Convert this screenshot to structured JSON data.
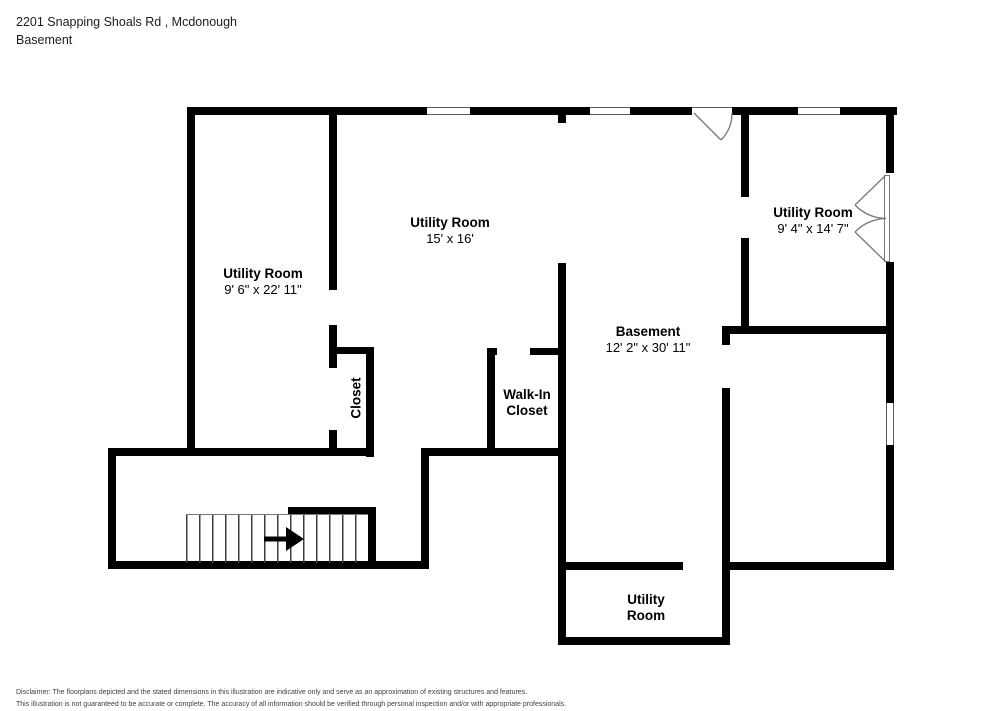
{
  "header": {
    "address": "2201 Snapping Shoals Rd , Mcdonough",
    "floor": "Basement"
  },
  "rooms": [
    {
      "id": "utility-left",
      "line1": "Utility Room",
      "line2": "9' 6\" x 22' 11\""
    },
    {
      "id": "utility-center",
      "line1": "Utility Room",
      "line2": "15' x 16'"
    },
    {
      "id": "utility-topright",
      "line1": "Utility Room",
      "line2": "9' 4\" x 14' 7\""
    },
    {
      "id": "basement",
      "line1": "Basement",
      "line2": "12' 2\" x 30' 11\""
    },
    {
      "id": "walkin-closet",
      "line1": "Walk-In",
      "line2": "Closet"
    },
    {
      "id": "closet",
      "line1": "Closet"
    },
    {
      "id": "utility-bottom",
      "line1": "Utility",
      "line2": "Room"
    }
  ],
  "disclaimer": {
    "line1": "Disclaimer: The floorplans depicted and the stated dimensions in this illustration are indicative only and serve as an approximation of existing structures and features.",
    "line2": "This illustration is not guaranteed to be accurate or complete. The accuracy of all information should be verified through personal inspection and/or with appropriate professionals."
  },
  "floorplan": {
    "wall_color": "#000000",
    "background_color": "#ffffff",
    "walls": [
      [
        187,
        107,
        240,
        8
      ],
      [
        470,
        107,
        120,
        8
      ],
      [
        630,
        107,
        62,
        8
      ],
      [
        732,
        107,
        66,
        8
      ],
      [
        840,
        107,
        57,
        8
      ],
      [
        108,
        448,
        265,
        8
      ],
      [
        421,
        448,
        145,
        8
      ],
      [
        337,
        347,
        37,
        7
      ],
      [
        487,
        348,
        10,
        7
      ],
      [
        530,
        348,
        36,
        7
      ],
      [
        722,
        326,
        172,
        8
      ],
      [
        558,
        562,
        125,
        8
      ],
      [
        722,
        562,
        172,
        8
      ],
      [
        108,
        561,
        321,
        8
      ],
      [
        558,
        637,
        172,
        8
      ],
      [
        288,
        507,
        88,
        7
      ],
      [
        187,
        107,
        8,
        349
      ],
      [
        108,
        448,
        8,
        121
      ],
      [
        329,
        107,
        8,
        183
      ],
      [
        329,
        325,
        8,
        43
      ],
      [
        329,
        430,
        8,
        26
      ],
      [
        366,
        347,
        8,
        110
      ],
      [
        368,
        507,
        8,
        62
      ],
      [
        421,
        448,
        8,
        121
      ],
      [
        487,
        348,
        8,
        108
      ],
      [
        558,
        107,
        8,
        16
      ],
      [
        558,
        263,
        8,
        382
      ],
      [
        741,
        107,
        8,
        90
      ],
      [
        741,
        238,
        8,
        96
      ],
      [
        722,
        326,
        8,
        19
      ],
      [
        722,
        388,
        8,
        257
      ],
      [
        886,
        107,
        8,
        66
      ],
      [
        886,
        262,
        8,
        141
      ],
      [
        886,
        445,
        8,
        123
      ]
    ],
    "windows": [
      {
        "x": 427,
        "y": 107,
        "w": 43,
        "h": 8,
        "o": "h"
      },
      {
        "x": 590,
        "y": 107,
        "w": 40,
        "h": 8,
        "o": "h"
      },
      {
        "x": 798,
        "y": 107,
        "w": 42,
        "h": 8,
        "o": "h"
      },
      {
        "x": 886,
        "y": 403,
        "w": 8,
        "h": 42,
        "o": "v"
      }
    ],
    "door_thresholds": [
      {
        "x": 692,
        "y": 107,
        "w": 40,
        "h": 8
      }
    ],
    "french_door_leaf_strip": {
      "x": 884,
      "y": 175,
      "w": 6,
      "h": 87
    },
    "stairs": {
      "x": 186,
      "y": 514,
      "w": 182,
      "h": 48,
      "tread_spacing": 13,
      "arrow_direction": "right"
    }
  }
}
